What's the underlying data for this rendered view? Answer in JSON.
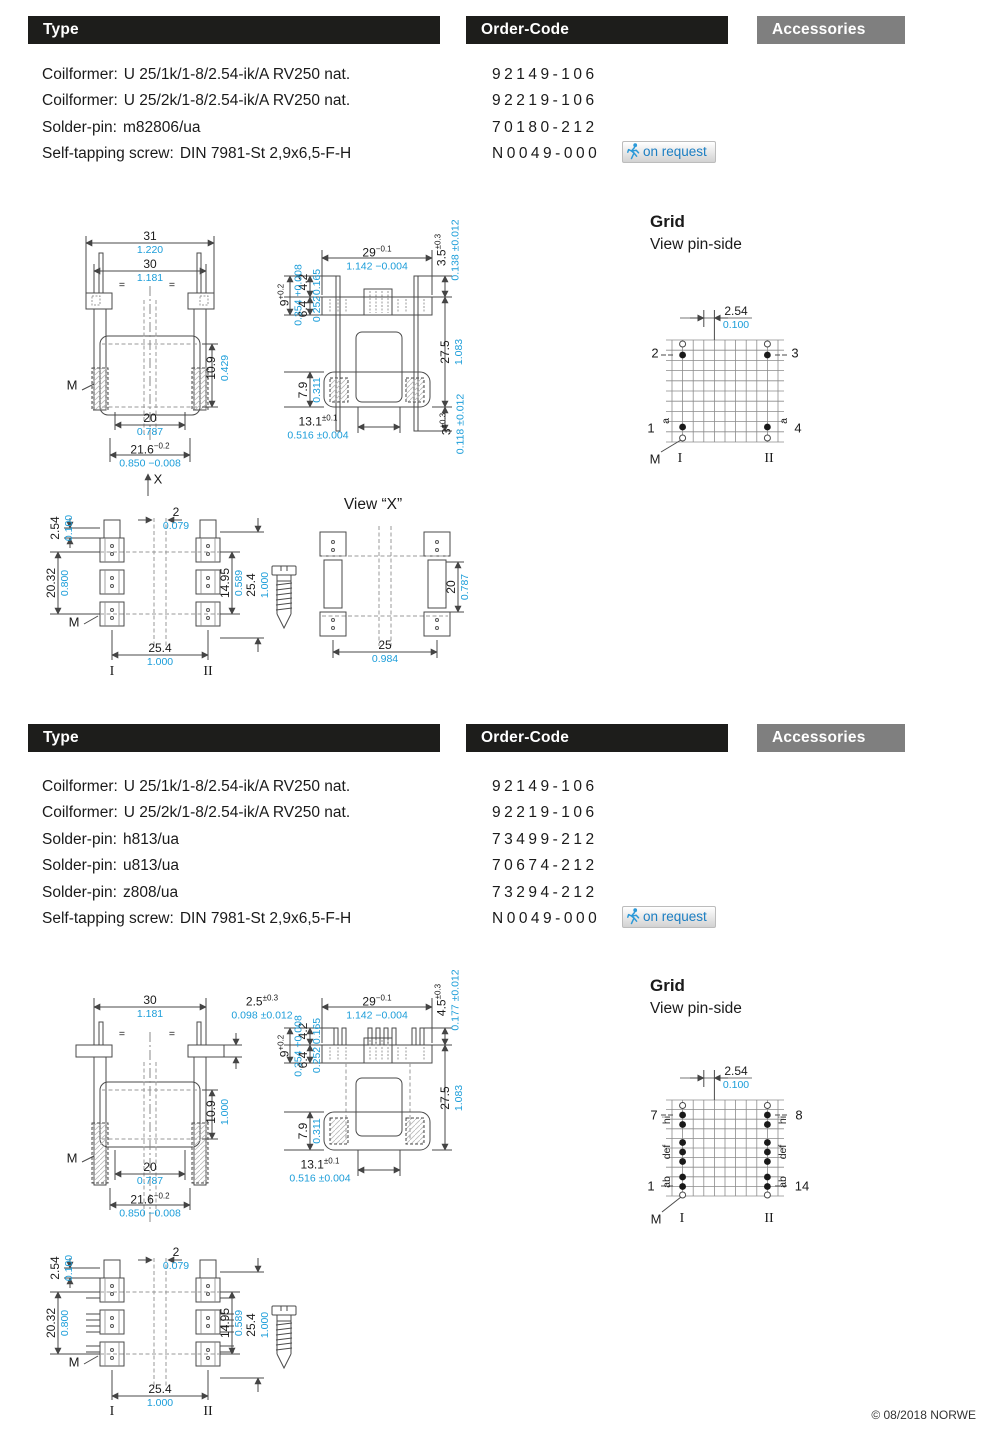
{
  "meta": {
    "copyright": "© 08/2018 NORWE"
  },
  "colors": {
    "accent_blue": "#1b9dd9",
    "bar_black": "#1d1d1b",
    "bar_gray": "#7f7f7f",
    "badge_text_blue": "#1b7ec2"
  },
  "on_request_label": "on request",
  "s1": {
    "bars": {
      "type": "Type",
      "code": "Order-Code",
      "acc": "Accessories"
    },
    "parts": [
      {
        "label": "Coilformer:",
        "name": "U 25/1k/1-8/2.54-ik/A RV250 nat.",
        "code": "92149-106"
      },
      {
        "label": "Coilformer:",
        "name": "U 25/2k/1-8/2.54-ik/A RV250 nat.",
        "code": "92219-106"
      },
      {
        "label": "Solder-pin:",
        "name": "m82806/ua",
        "code": "70180-212"
      },
      {
        "label": "Self-tapping screw:",
        "name": "DIN 7981-St 2,9x6,5-F-H",
        "code": "N0049-000"
      }
    ],
    "front": {
      "d31": {
        "mm": "31",
        "in": "1.220"
      },
      "d30": {
        "mm": "30",
        "in": "1.181"
      },
      "d109": {
        "mm": "10.9",
        "in": "0.429"
      },
      "d20": {
        "mm": "20",
        "in": "0.787"
      },
      "d216": {
        "mm": "21.6",
        "mmt": "−0.2",
        "in": "0.850 −0.008"
      },
      "m": "M",
      "eq": "="
    },
    "side": {
      "d29": {
        "mm": "29",
        "mmt": "−0.1",
        "in": "1.142 −0.004"
      },
      "d42": {
        "mm": "4.2",
        "in": "0.165"
      },
      "d9": {
        "mm": "9",
        "mmt": "+0.2",
        "in": "0.354 +0.008"
      },
      "d64": {
        "mm": "6.4",
        "in": "0.252"
      },
      "d79": {
        "mm": "7.9",
        "in": "0.311"
      },
      "d275": {
        "mm": "27.5",
        "in": "1.083"
      },
      "d35": {
        "mm": "3.5",
        "mmt": "±0.3",
        "in": "0.138 ±0.012"
      },
      "d3": {
        "mm": "3",
        "mmt": "±0.3",
        "in": "0.118 ±0.012"
      },
      "d131": {
        "mm": "13.1",
        "mmt": "±0.1",
        "in": "0.516 ±0.004"
      }
    },
    "bottom": {
      "x": "X",
      "d254p": {
        "mm": "2.54",
        "in": "0.100"
      },
      "d2": {
        "mm": "2",
        "in": "0.079"
      },
      "d2032": {
        "mm": "20.32",
        "in": "0.800"
      },
      "d1495": {
        "mm": "14.95",
        "in": "0.589"
      },
      "d254v": {
        "mm": "25.4",
        "in": "1.000"
      },
      "d254h": {
        "mm": "25.4",
        "in": "1.000"
      },
      "m": "M",
      "c1": "I",
      "c2": "II"
    },
    "viewx": {
      "title": "View “X”",
      "d20": {
        "mm": "20",
        "in": "0.787"
      },
      "d25": {
        "mm": "25",
        "in": "0.984"
      }
    },
    "grid": {
      "title": "Grid",
      "subtitle": "View pin-side",
      "pitch": {
        "mm": "2.54",
        "in": "0.100"
      },
      "tl": "2",
      "tr": "3",
      "bl": "1",
      "br": "4",
      "la": "a",
      "ra": "a",
      "m": "M",
      "c1": "I",
      "c2": "II"
    }
  },
  "s2": {
    "bars": {
      "type": "Type",
      "code": "Order-Code",
      "acc": "Accessories"
    },
    "parts": [
      {
        "label": "Coilformer:",
        "name": "U 25/1k/1-8/2.54-ik/A RV250 nat.",
        "code": "92149-106"
      },
      {
        "label": "Coilformer:",
        "name": "U 25/2k/1-8/2.54-ik/A RV250 nat.",
        "code": "92219-106"
      },
      {
        "label": "Solder-pin:",
        "name": "h813/ua",
        "code": "73499-212"
      },
      {
        "label": "Solder-pin:",
        "name": "u813/ua",
        "code": "70674-212"
      },
      {
        "label": "Solder-pin:",
        "name": "z808/ua",
        "code": "73294-212"
      },
      {
        "label": "Self-tapping screw:",
        "name": "DIN 7981-St 2,9x6,5-F-H",
        "code": "N0049-000"
      }
    ],
    "front": {
      "d30": {
        "mm": "30",
        "in": "1.181"
      },
      "d25t": {
        "mm": "2.5",
        "mmt": "±0.3",
        "in": "0.098 ±0.012"
      },
      "d109": {
        "mm": "10.9",
        "in": "1.000"
      },
      "d20": {
        "mm": "20",
        "in": "0.787"
      },
      "d216": {
        "mm": "21.6",
        "mmt": "−0.2",
        "in": "0.850 −0.008"
      },
      "m": "M",
      "eq": "="
    },
    "side": {
      "d29": {
        "mm": "29",
        "mmt": "−0.1",
        "in": "1.142 −0.004"
      },
      "d42": {
        "mm": "4.2",
        "in": "0.165"
      },
      "d9": {
        "mm": "9",
        "mmt": "+0.2",
        "in": "0.354 +0.008"
      },
      "d64": {
        "mm": "6.4",
        "in": "0.252"
      },
      "d79": {
        "mm": "7.9",
        "in": "0.311"
      },
      "d275": {
        "mm": "27.5",
        "in": "1.083"
      },
      "d45": {
        "mm": "4.5",
        "mmt": "±0.3",
        "in": "0.177 ±0.012"
      },
      "d131": {
        "mm": "13.1",
        "mmt": "±0.1",
        "in": "0.516 ±0.004"
      }
    },
    "bottom": {
      "d254p": {
        "mm": "2.54",
        "in": "0.100"
      },
      "d2": {
        "mm": "2",
        "in": "0.079"
      },
      "d2032": {
        "mm": "20.32",
        "in": "0.800"
      },
      "d1495": {
        "mm": "14.95",
        "in": "0.589"
      },
      "d254v": {
        "mm": "25.4",
        "in": "1.000"
      },
      "d254h": {
        "mm": "25.4",
        "in": "1.000"
      },
      "m": "M",
      "c1": "I",
      "c2": "II"
    },
    "grid": {
      "title": "Grid",
      "subtitle": "View pin-side",
      "pitch": {
        "mm": "2.54",
        "in": "0.100"
      },
      "tl": "7",
      "tr": "8",
      "bl": "1",
      "br": "14",
      "lg1": "ab",
      "lg2": "def",
      "lg3": "hi",
      "m": "M",
      "c1": "I",
      "c2": "II"
    }
  }
}
